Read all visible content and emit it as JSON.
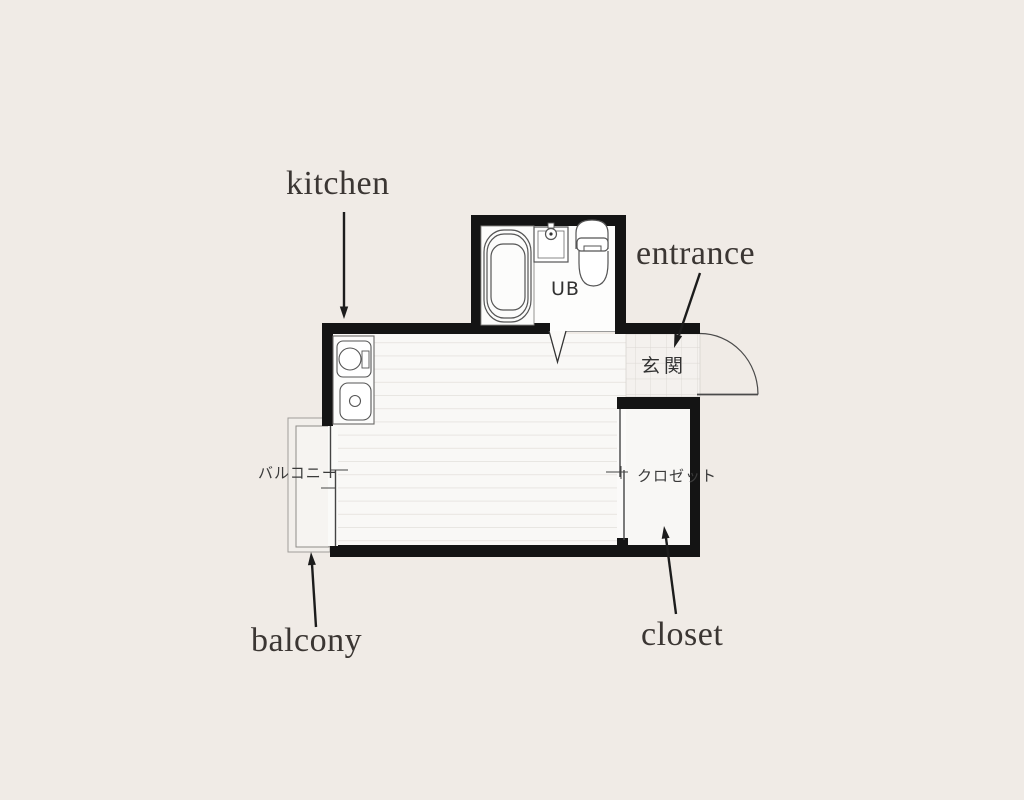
{
  "page": {
    "background": "#f0ebe6",
    "description": "Japanese studio apartment floor plan with annotation arrows"
  },
  "plan": {
    "colors": {
      "wall": "#141414",
      "room_floor": "#f9f8f6",
      "floor_line": "#e8e5e1",
      "bath_floor": "#fdfdfc",
      "tile_floor": "#f4f1ee",
      "tile_line": "#dcd8d3",
      "fixture_line": "#4d4d4d",
      "annotation_arrow": "#1c1c1c",
      "label_text": "#3b3633"
    },
    "annotations": [
      {
        "id": "kitchen",
        "label": "kitchen"
      },
      {
        "id": "entrance",
        "label": "entrance"
      },
      {
        "id": "balcony",
        "label": "balcony"
      },
      {
        "id": "closet",
        "label": "closet"
      }
    ],
    "room_labels": {
      "unit_bath": "UB",
      "entrance_jp": "玄関",
      "balcony_jp": "バルコニー",
      "closet_jp": "クロゼット"
    },
    "icons": {
      "bathtub": "bathtub-icon",
      "bath_sink": "washbasin-icon",
      "toilet": "toilet-icon",
      "stove": "stove-burner-icon",
      "kitchen_sink": "kitchen-sink-icon",
      "entrance_door": "door-swing-arc",
      "bath_door": "folding-door-v",
      "balcony_door": "sliding-door",
      "closet_door": "sliding-door"
    }
  }
}
